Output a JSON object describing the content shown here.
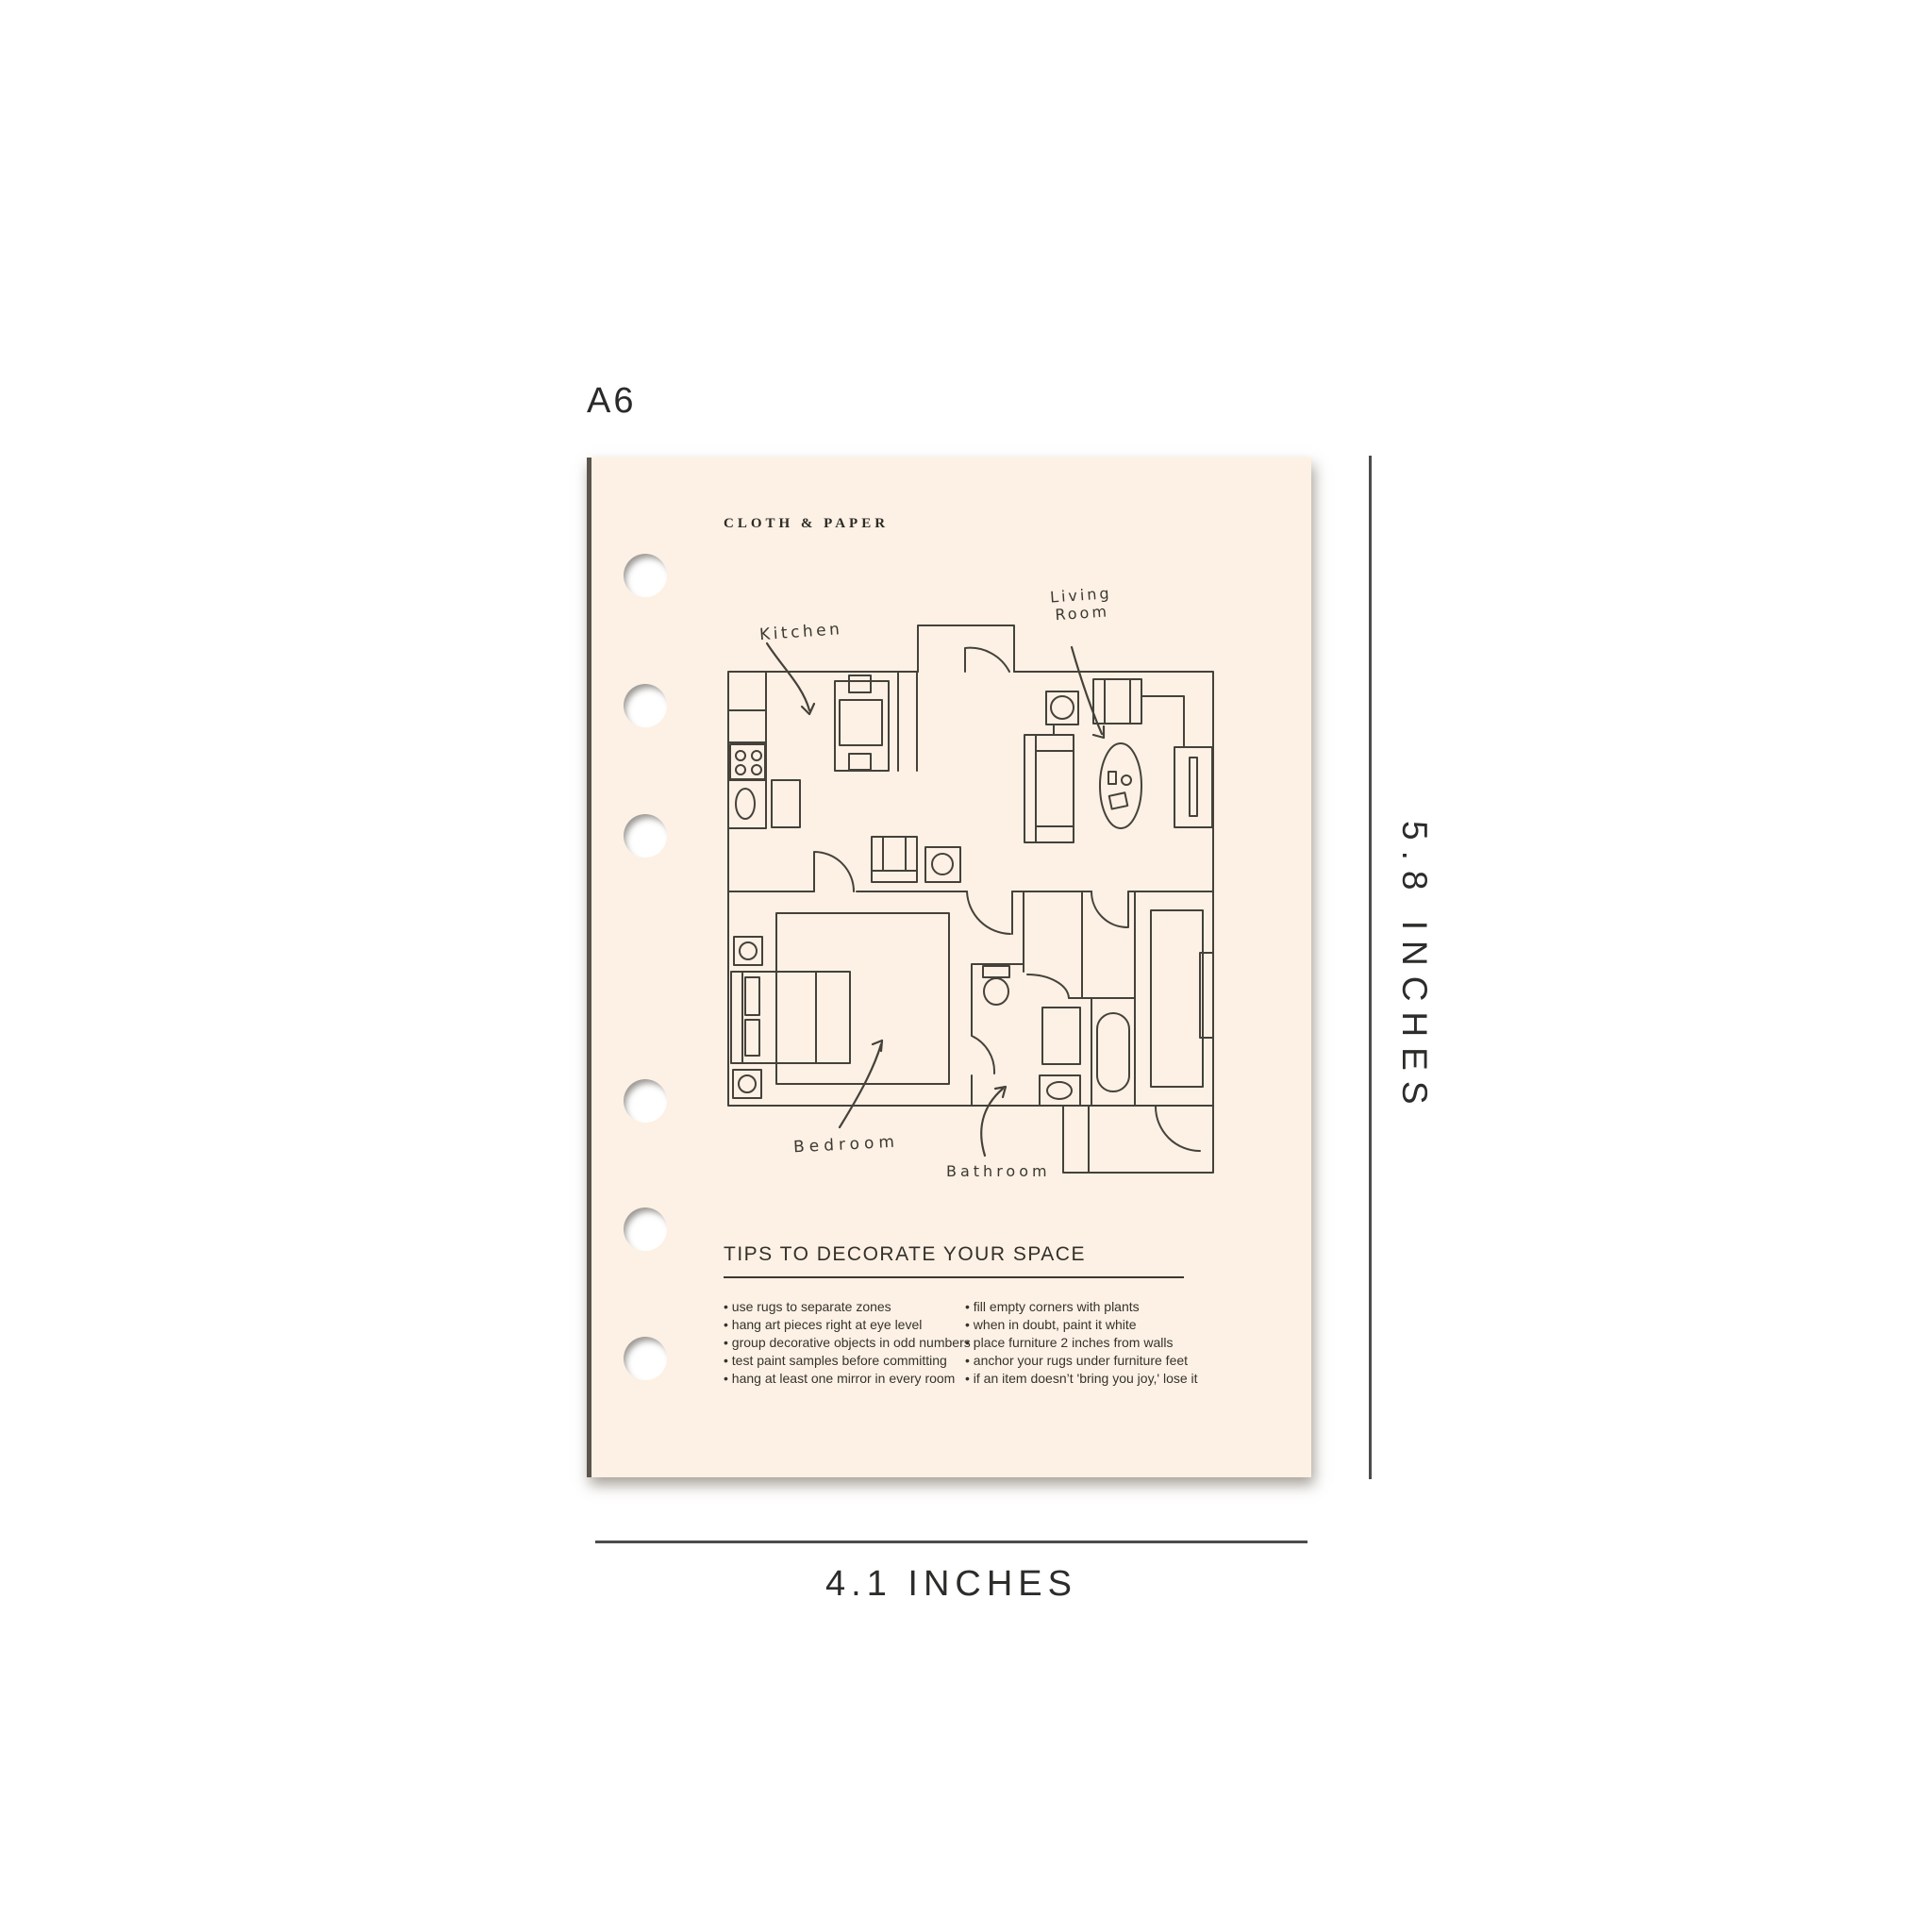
{
  "size_label": "A6",
  "dimensions": {
    "height_label": "5.8 INCHES",
    "width_label": "4.1 INCHES"
  },
  "page": {
    "brand": "CLOTH & PAPER",
    "floor_plan": {
      "labels": {
        "kitchen": "Kitchen",
        "living_room_line1": "Living",
        "living_room_line2": "Room",
        "bedroom": "Bedroom",
        "bathroom": "Bathroom"
      }
    },
    "tips": {
      "heading": "TIPS TO DECORATE YOUR SPACE",
      "left_column": [
        "use rugs to separate zones",
        "hang art pieces right at eye level",
        "group decorative objects in odd numbers",
        "test paint samples before committing",
        "hang at least one mirror in every room"
      ],
      "right_column": [
        "fill empty corners with plants",
        "when in doubt, paint it white",
        "place furniture 2 inches from walls",
        "anchor your rugs under furniture feet",
        "if an item doesn’t 'bring you joy,' lose it"
      ]
    }
  },
  "colors": {
    "paper": "#FCF1E4",
    "ink": "#45413b",
    "measure_line": "#4c4c4c",
    "text": "#2b2824"
  }
}
